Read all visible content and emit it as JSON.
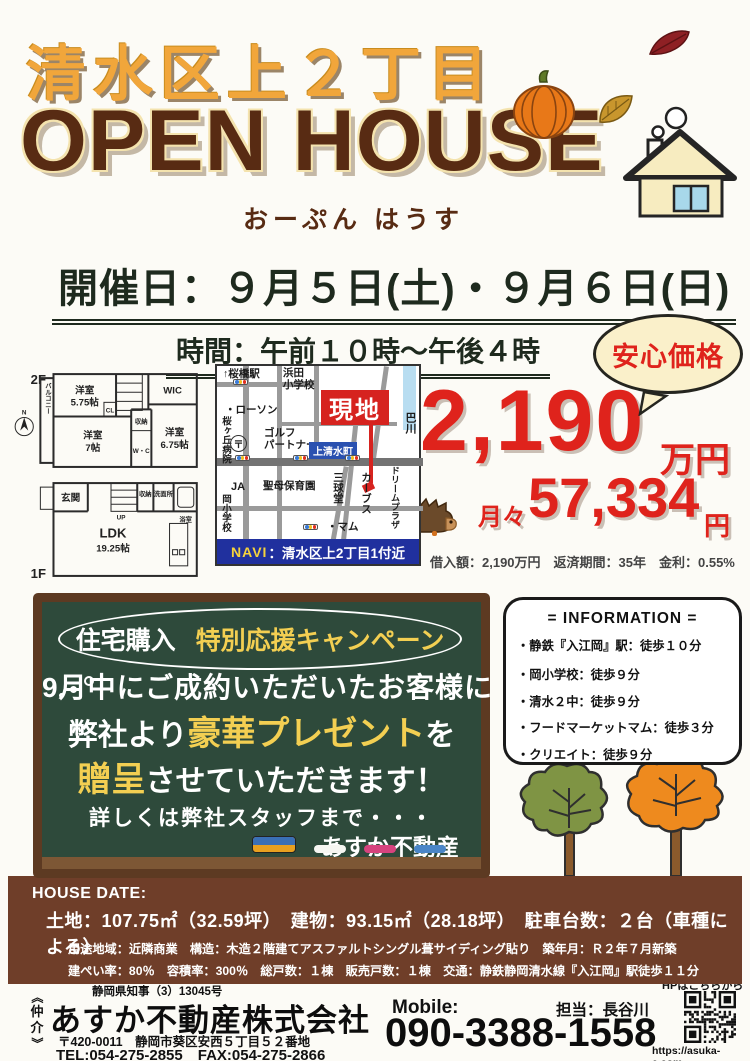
{
  "header": {
    "location_title": "清水区上２丁目",
    "main_title": "OPEN HOUSE",
    "furigana": "おーぷん はうす"
  },
  "event": {
    "date_line": "開催日：９月５日(土)・９月６日(日)",
    "time_line": "時間：午前１０時～午後４時",
    "price_badge": "安心価格"
  },
  "price": {
    "amount": "2,190",
    "unit": "万円",
    "monthly_label": "月々",
    "monthly_amount": "57,334",
    "monthly_unit": "円",
    "loan_terms": "借入額：2,190万円　返済期間：35年　金利：0.55%"
  },
  "floorplan": {
    "floor2_label": "2F",
    "floor1_label": "1F",
    "north": "N",
    "balcony": "バルコニー",
    "room2_1": "洋室",
    "room2_1_size": "5.75帖",
    "cl": "CL",
    "wic": "WIC",
    "room2_2": "洋室",
    "room2_2_size": "7帖",
    "storage2": "収納",
    "wc": "W・C",
    "room2_3": "洋室",
    "room2_3_size": "6.75帖",
    "genkan": "玄関",
    "up": "UP",
    "storage1": "収納",
    "wash": "洗面所",
    "bath": "浴室",
    "ldk": "LDK",
    "ldk_size": "19.25帖"
  },
  "map": {
    "station": "↑桜橋駅",
    "hamada_school": "浜田\n小学校",
    "lawson": "・ローソン",
    "hospital": "桜ヶ丘病院",
    "post": "〒",
    "golf": "ゴルフ\nパートナー",
    "town": "上清水町",
    "genchi": "現地",
    "river": "巴川",
    "ja": "JA",
    "seibo": "聖母保育園",
    "sankyudo": "三球堂",
    "mam": "・マム",
    "curves": "カーブス",
    "dream_plaza": "ドリームプラザ",
    "oka_school": "岡小学校",
    "navi_label": "NAVI",
    "navi_text": "：清水区上2丁目1付近"
  },
  "campaign": {
    "bubble_left": "住宅購入",
    "bubble_right": "特別応援キャンペーン",
    "line1": "9月中にご成約いただいたお客様に",
    "line2_pre": "弊社より",
    "line2_em": "豪華プレゼント",
    "line2_post": "を",
    "line3_em": "贈呈",
    "line3_post": "させていただきます！",
    "line4": "詳しくは弊社スタッフまで・・・",
    "signature": "あすか不動産"
  },
  "information": {
    "title": "= INFORMATION =",
    "items": [
      "・静鉄『入江岡』駅：徒歩１０分",
      "・岡小学校：徒歩９分",
      "・清水２中：徒歩９分",
      "・フードマーケットマム：徒歩３分",
      "・クリエイト：徒歩９分"
    ]
  },
  "house_data": {
    "title": "HOUSE DATE:",
    "line1": "土地：107.75㎡（32.59坪）　建物：93.15㎡（28.18坪）　駐車台数：２台（車種による）",
    "line2": "用途地域：近隣商業　構造：木造２階建てアスファルトシングル葺サイディング貼り　築年月：Ｒ２年７月新築",
    "line3": "建ぺい率：80％　容積率：300％　総戸数：１棟　販売戸数：１棟　交通：静鉄静岡清水線『入江岡』駅徒歩１１分"
  },
  "footer": {
    "broker": [
      "《",
      "仲",
      "介",
      "》"
    ],
    "license": "静岡県知事（3）13045号",
    "company": "あすか不動産株式会社",
    "address": "〒420-0011　静岡市葵区安西５丁目５２番地",
    "tel_fax": "TEL:054-275-2855　FAX:054-275-2866",
    "mobile_label": "Mobile:",
    "mobile_number": "090-3388-1558",
    "contact": "担当：長谷川",
    "hp_label": "HPはこちらから",
    "url": "https://asuka-e.com"
  },
  "colors": {
    "title_orange": "#f1a63b",
    "title_brown": "#582b13",
    "price_red": "#df231c",
    "board_green": "#2e4a3b",
    "band_brown": "#6f3e29",
    "navi_blue": "#20309e"
  }
}
